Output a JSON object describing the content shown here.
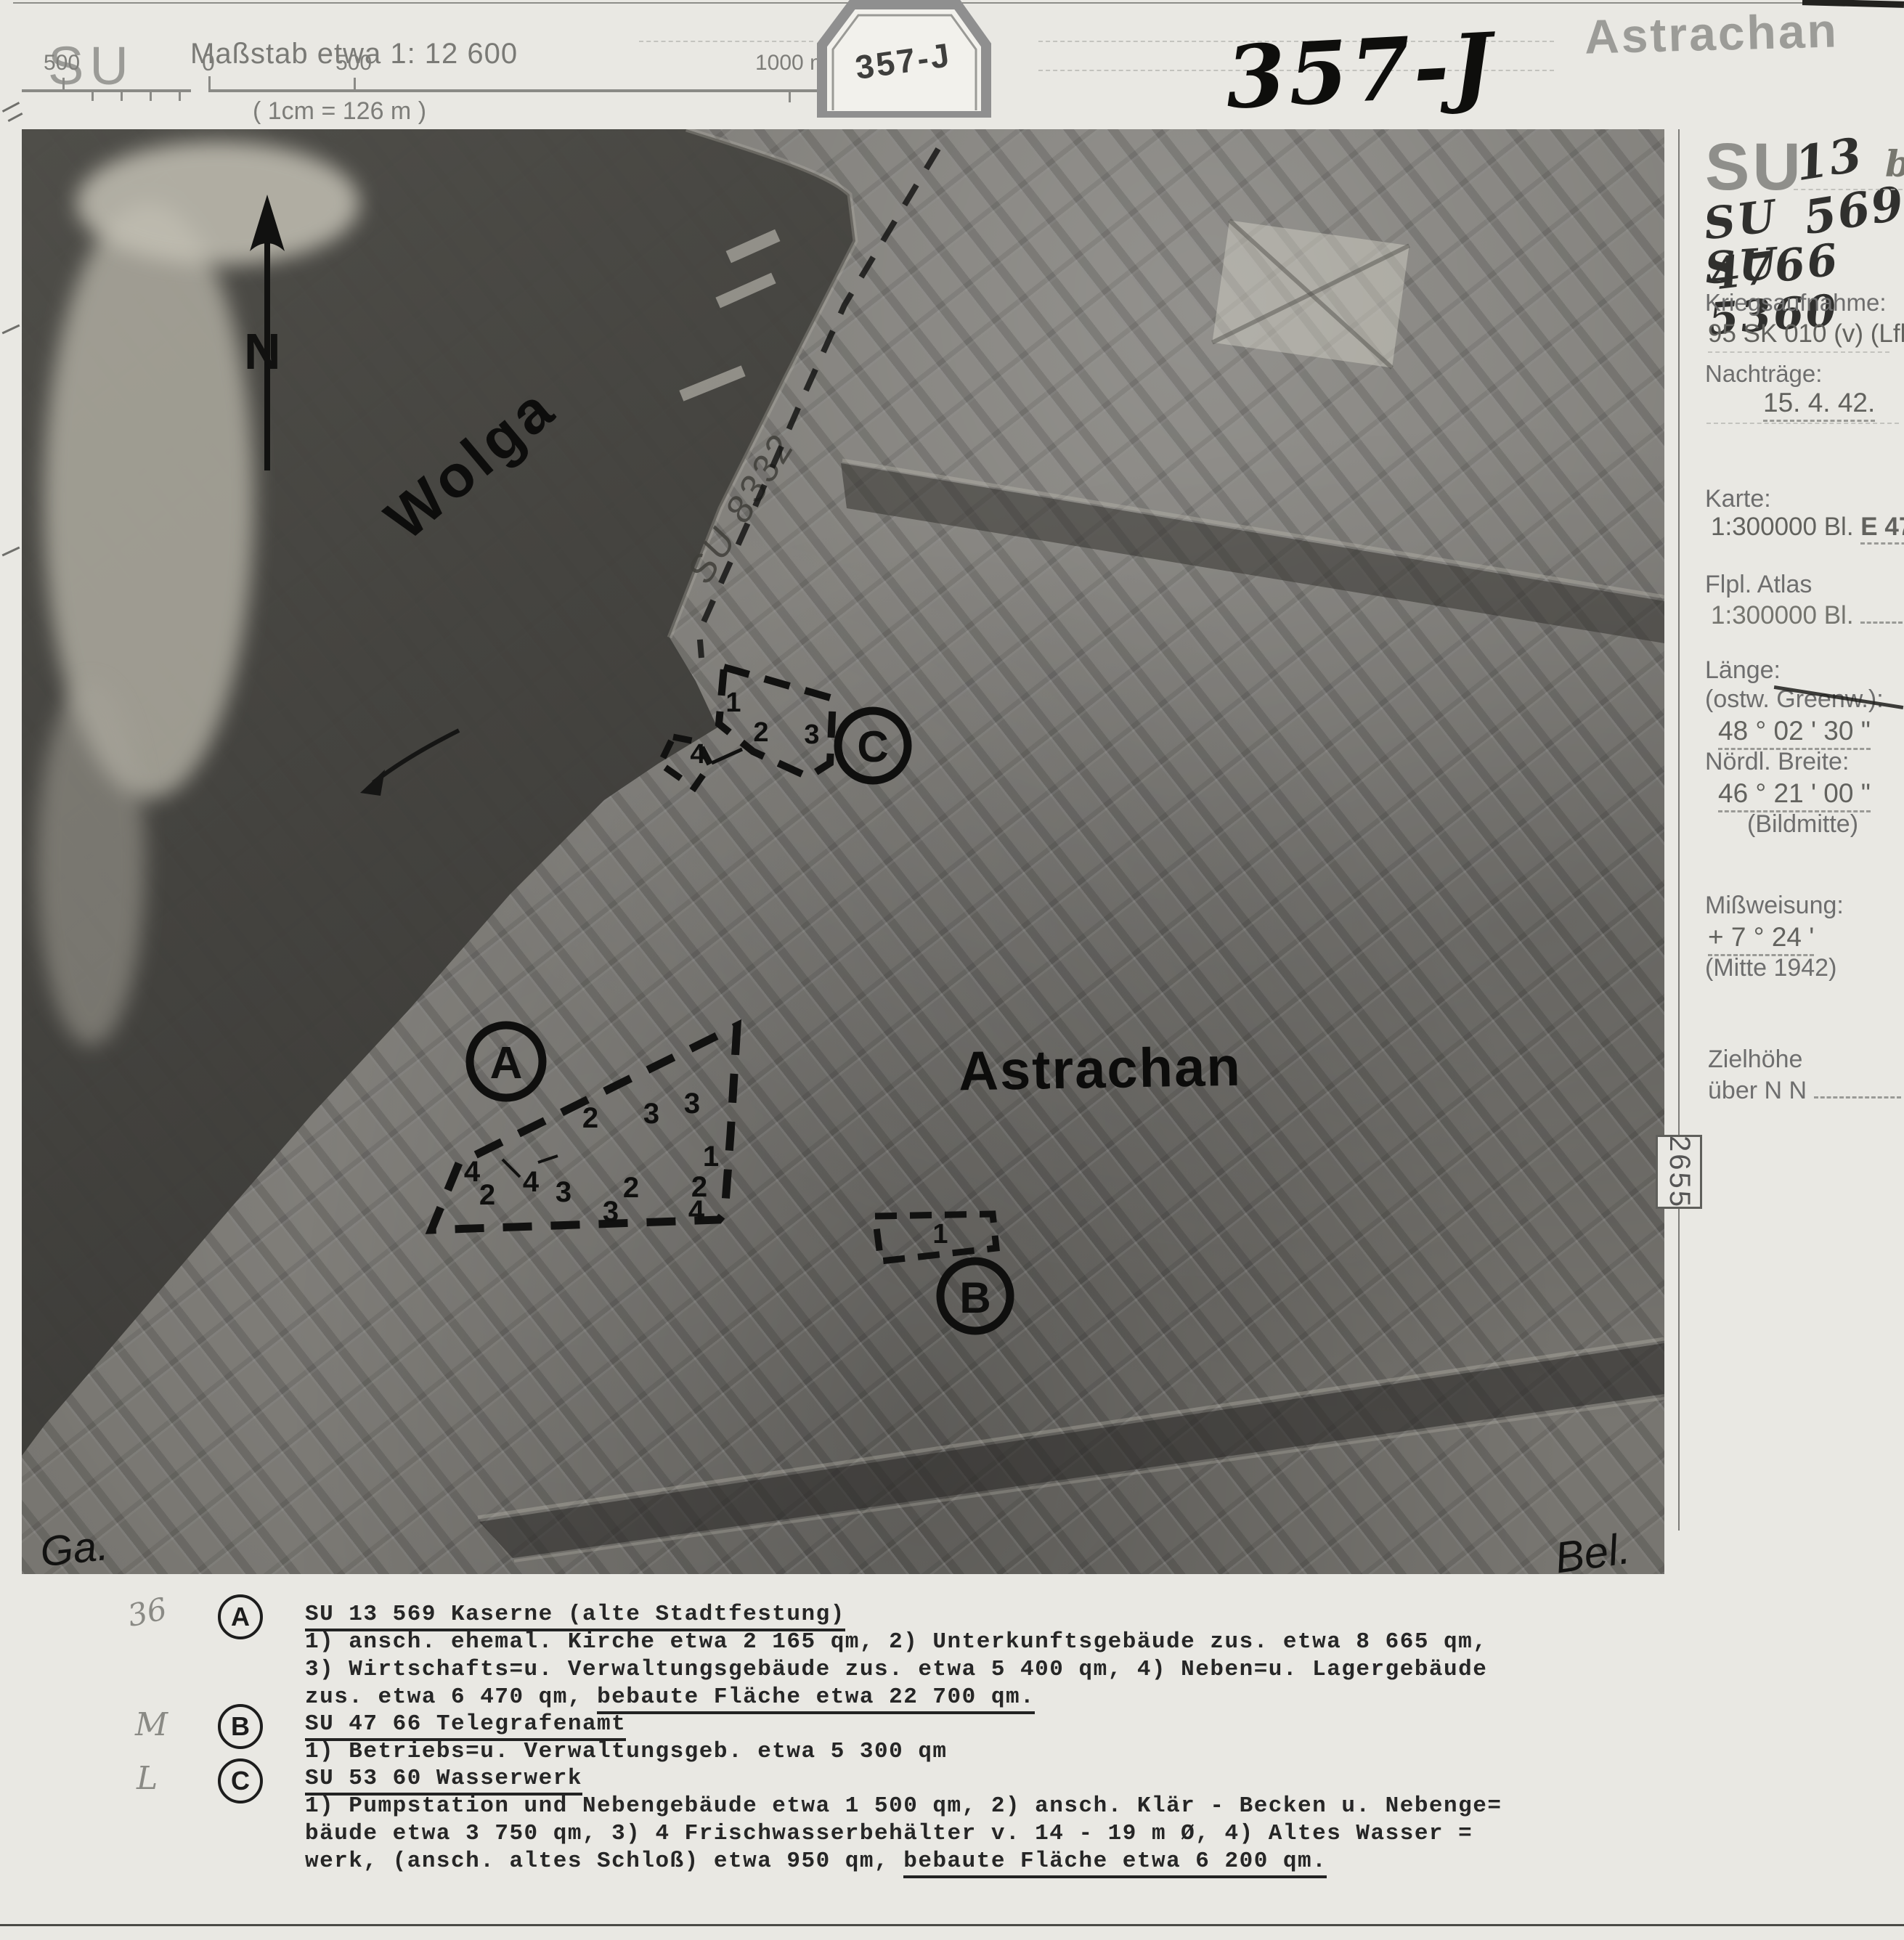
{
  "colors": {
    "paper": "#e9e8e3",
    "ink": "#1c1c1c",
    "stamp_gray": "#8f8f8f",
    "label_gray": "#6e6e6e"
  },
  "header": {
    "su_label": "SU",
    "scale_label": "Maßstab etwa 1: 12 600",
    "scale_note": "( 1cm  =  126 m )",
    "scale_ticks": {
      "left_500": "500",
      "zero": "0",
      "right_500": "500",
      "thousand": "1000 m"
    },
    "stamp_number": "357-J",
    "handwritten_number": "357-J",
    "title": "Astrachan"
  },
  "sidebar": {
    "su_printed": "SU",
    "ref1_num": "13 569",
    "ref1_suffix": "b",
    "ref2": "SU 4766",
    "ref3": "SU 5360",
    "kriegsaufnahme_label": "Kriegsaufnahme:",
    "kriegsaufnahme_value": "95 SK 010 (v) (Lfl.4",
    "nachtraege_label": "Nachträge:",
    "nachtraege_value": "15. 4. 42.",
    "karte_label": "Karte:",
    "karte_line": "1:300000 Bl.",
    "karte_sheet": "E 47",
    "flpl_label": "Flpl. Atlas",
    "flpl_line": "1:300000 Bl.",
    "laenge_label": "Länge:",
    "laenge_sublabel": "(ostw. Greenw.):",
    "laenge_value": "48 °  02 '  30 \"",
    "breite_label": "Nördl. Breite:",
    "breite_value": "46 °  21 '  00 \"",
    "bildmitte": "(Bildmitte)",
    "missweisung_label": "Mißweisung:",
    "missweisung_value": "+   7 °  24 '",
    "missweisung_note": "(Mitte 1942)",
    "zielhoehe_label": "Zielhöhe",
    "zielhoehe_value": "über N N",
    "zielhoehe_unit": "m",
    "film_number": "2655"
  },
  "photo": {
    "river_label": "Wolga",
    "city_label": "Astrachan",
    "north_label": "N",
    "pencil_ref": "SU 8332",
    "sig_left": "Ga.",
    "sig_right": "Bel.",
    "area_a": {
      "letter": "A",
      "numbers": [
        "2",
        "3",
        "3",
        "1",
        "4",
        "4",
        "2",
        "3",
        "2",
        "2",
        "3",
        "4"
      ]
    },
    "area_b": {
      "letter": "B",
      "numbers": [
        "1"
      ]
    },
    "area_c": {
      "letter": "C",
      "numbers": [
        "1",
        "2",
        "3",
        "4"
      ]
    }
  },
  "legend": {
    "margin_marks": [
      "36",
      "M",
      "L"
    ],
    "entries": [
      {
        "letter": "A",
        "title": "SU 13 569 Kaserne (alte Stadtfestung)",
        "lines": [
          "1) ansch. ehemal. Kirche etwa 2 165 qm, 2) Unterkunftsgebäude zus. etwa 8 665 qm,",
          "3) Wirtschafts=u. Verwaltungsgebäude zus. etwa 5 400 qm, 4) Neben=u. Lagergebäude"
        ],
        "last_line_prefix": "zus. etwa 6 470 qm, ",
        "last_line_underlined": "bebaute Fläche etwa 22 700 qm."
      },
      {
        "letter": "B",
        "title": "SU 47 66 Telegrafenamt",
        "lines": [
          "1) Betriebs=u. Verwaltungsgeb. etwa 5 300 qm"
        ],
        "last_line_prefix": "",
        "last_line_underlined": ""
      },
      {
        "letter": "C",
        "title": "SU 53 60 Wasserwerk",
        "lines": [
          "1) Pumpstation und Nebengebäude etwa 1 500 qm, 2) ansch. Klär - Becken u. Nebenge=",
          "bäude etwa 3 750 qm, 3) 4 Frischwasserbehälter v. 14 - 19 m Ø, 4) Altes Wasser ="
        ],
        "last_line_prefix": "werk, (ansch. altes Schloß) etwa 950 qm, ",
        "last_line_underlined": "bebaute Fläche etwa 6 200 qm."
      }
    ]
  }
}
